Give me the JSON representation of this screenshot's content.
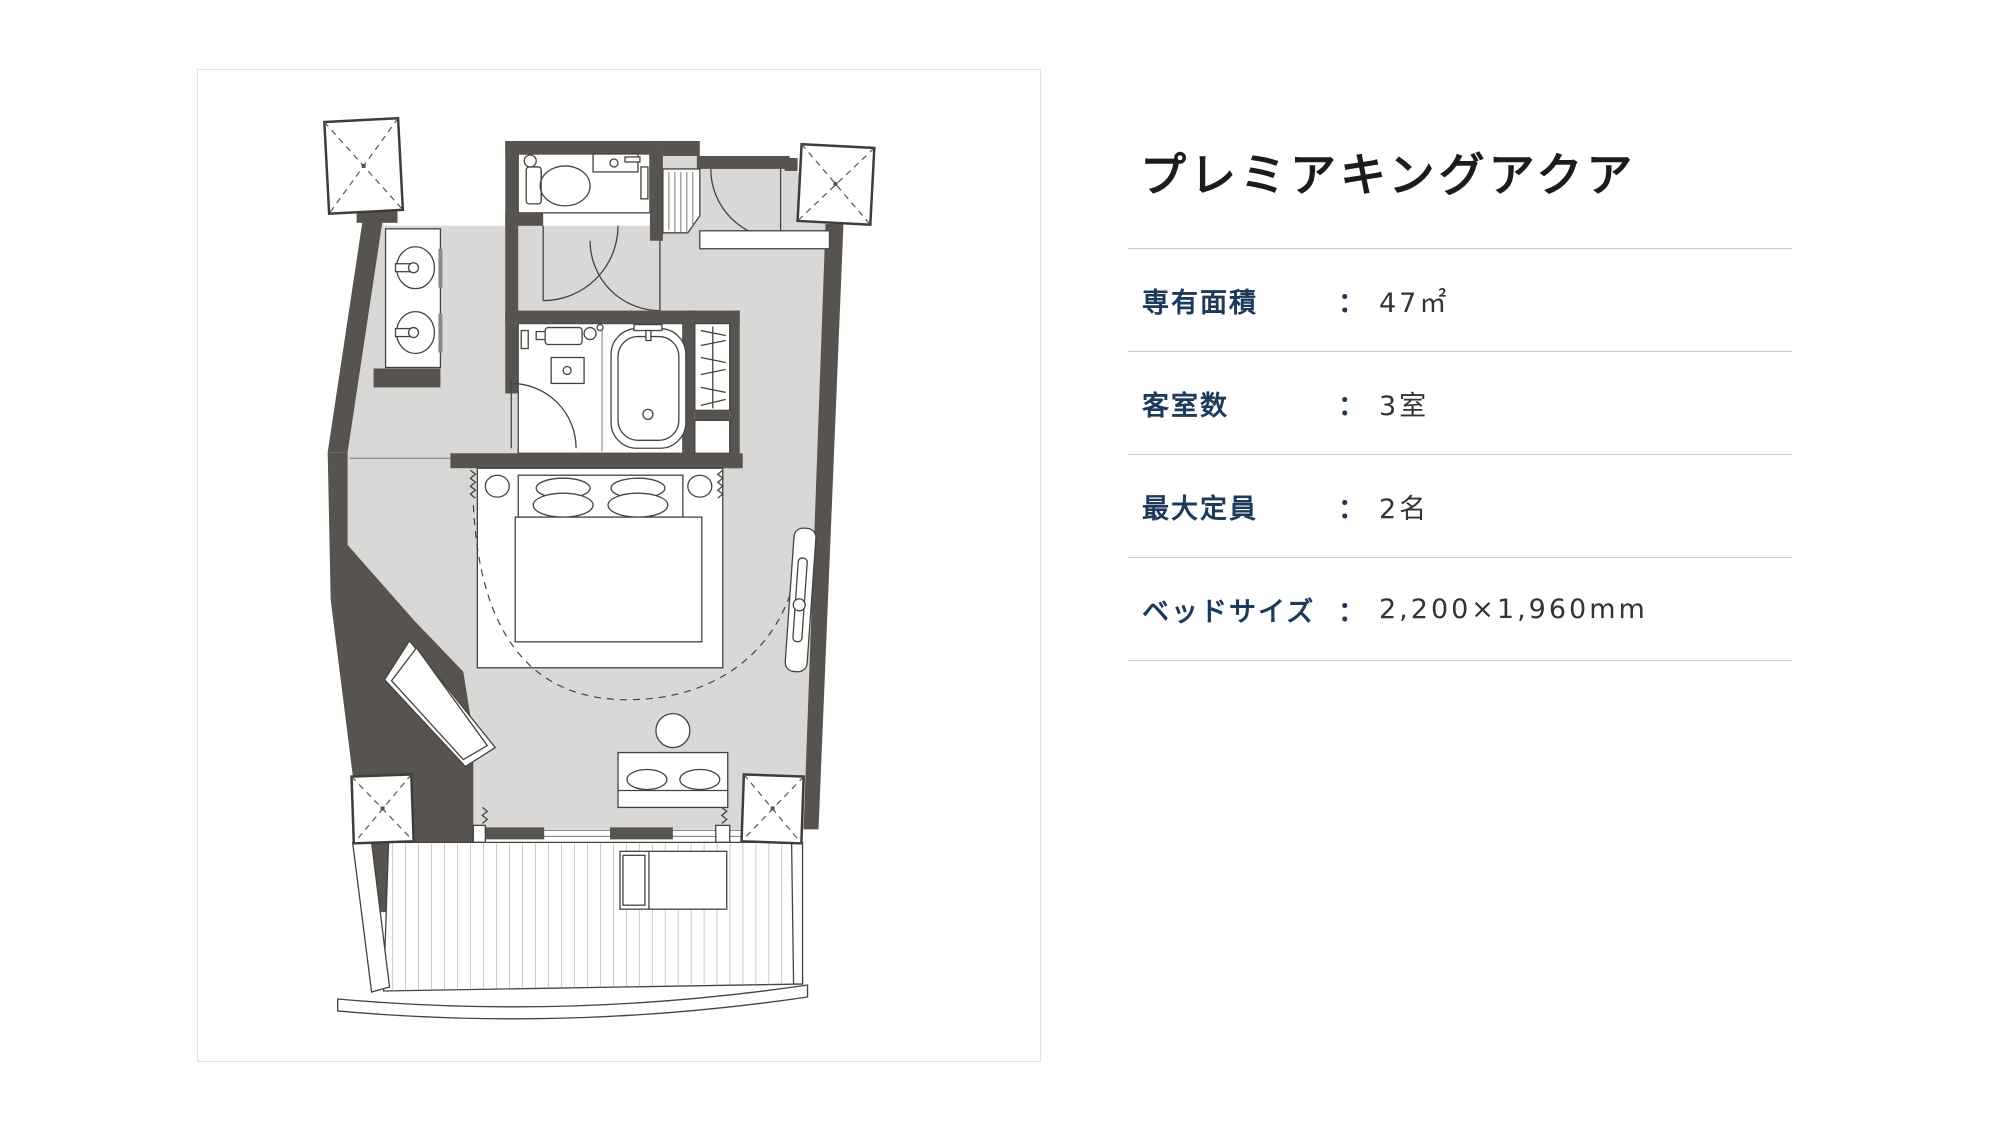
{
  "page": {
    "background": "#ffffff",
    "accent_navy": "#1d3a5c",
    "wall_color": "#57534f",
    "floor_color": "#d9d8d6",
    "divider_color": "#c9c9c9"
  },
  "room": {
    "title": "プレミアキングアクア"
  },
  "details": {
    "separator": "：",
    "rows": [
      {
        "label": "専有面積",
        "value": "47㎡"
      },
      {
        "label": "客室数",
        "value": "3室"
      },
      {
        "label": "最大定員",
        "value": "2名"
      },
      {
        "label": "ベッドサイズ",
        "value": "2,200×1,960mm"
      }
    ]
  },
  "floor_plan": {
    "description": "guest room floor plan",
    "elements": [
      "toilet-room",
      "vanity-double-sink",
      "bathroom-bathtub",
      "closet",
      "entrance-door",
      "king-bed",
      "window-bay",
      "desk",
      "stool",
      "mirror",
      "balcony-deck",
      "lounger",
      "structural-columns"
    ]
  }
}
